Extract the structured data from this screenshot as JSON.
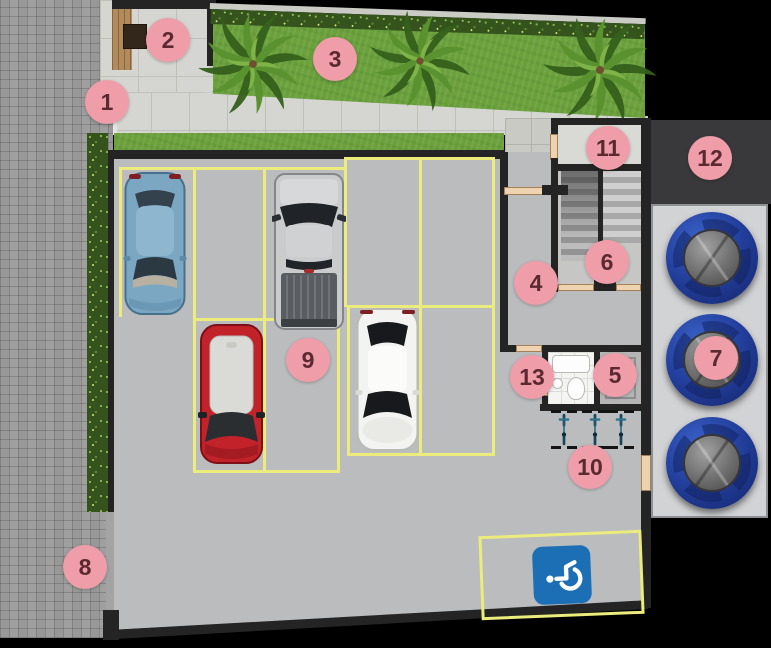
{
  "plan": {
    "markers": [
      {
        "label": "1"
      },
      {
        "label": "2"
      },
      {
        "label": "3"
      },
      {
        "label": "4"
      },
      {
        "label": "5"
      },
      {
        "label": "6"
      },
      {
        "label": "7"
      },
      {
        "label": "8"
      },
      {
        "label": "9"
      },
      {
        "label": "10"
      },
      {
        "label": "11"
      },
      {
        "label": "12"
      },
      {
        "label": "13"
      }
    ],
    "marker_fill": "#ef9da9",
    "marker_text": "#5b2a31",
    "icons": {
      "accessible_parking": "wheelchair-icon"
    },
    "objects": {
      "cars": [
        "blue-car",
        "silver-pickup",
        "red-car",
        "white-car"
      ],
      "water_tanks": 3,
      "bicycles": 3,
      "palm_trees": 3
    },
    "colors": {
      "background": "#000000",
      "paver_sidewalk": "#989898",
      "grass": "#6ba03c",
      "hedge": "#34531d",
      "walkway_tile": "#d5d6d2",
      "corridor_tile": "#c9cac4",
      "garage_floor": "#babcbe",
      "wall": "#242424",
      "parking_line": "#ecec7d",
      "door": "#eed3b0",
      "wood_deck": "#b28b5d",
      "accessible_sign_blue": "#1d6fb5",
      "tank_body_navy": "#24419f",
      "tank_lid_gray": "#6e6e6e",
      "car_blue": "#7ca7c2",
      "car_silver": "#c9cbcd",
      "car_red": "#c2232b",
      "car_white": "#f3f3f1",
      "bike_blue": "#2f748f"
    }
  }
}
